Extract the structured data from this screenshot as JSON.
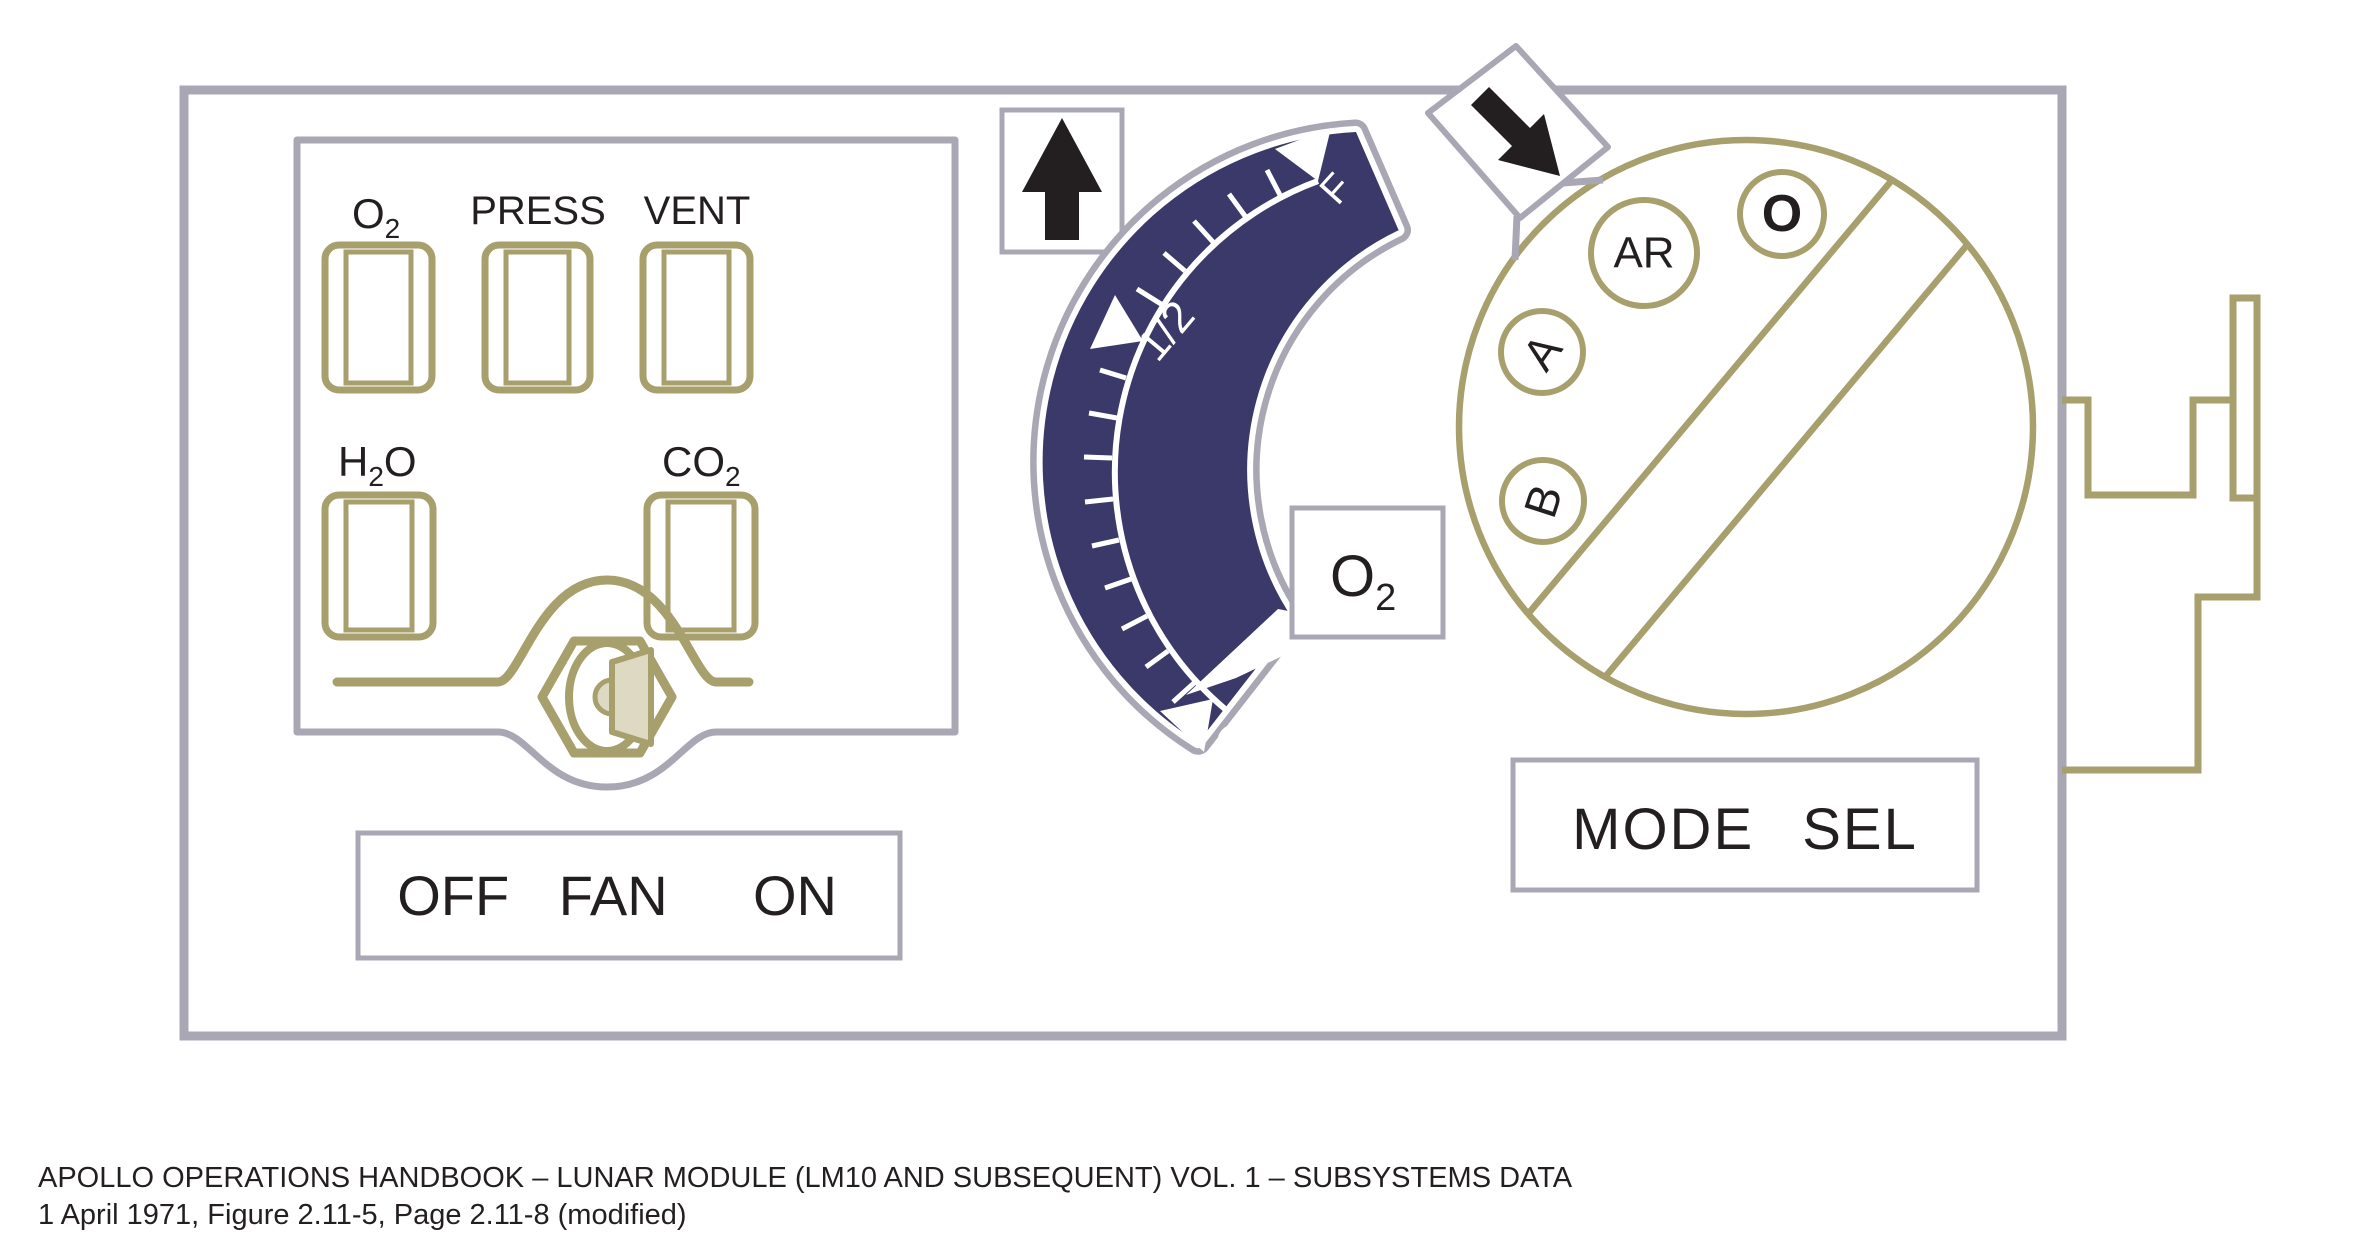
{
  "colors": {
    "panel_outline_gray": "#a8a7b3",
    "accent_olive": "#a79f6c",
    "gauge_navy": "#3b3969",
    "toggle_tan": "#ded9c3",
    "text_black": "#231f20",
    "scale_white": "#ffffff"
  },
  "left_panel": {
    "windows": [
      {
        "name": "O2",
        "pre": "O",
        "sub": "2",
        "post": ""
      },
      {
        "name": "PRESS",
        "pre": "PRESS",
        "sub": "",
        "post": ""
      },
      {
        "name": "VENT",
        "pre": "VENT",
        "sub": "",
        "post": ""
      },
      {
        "name": "H2O",
        "pre": "H",
        "sub": "2",
        "post": "O"
      },
      {
        "name": "CO2",
        "pre": "CO",
        "sub": "2",
        "post": ""
      }
    ],
    "fan_switch": {
      "labels": [
        "OFF",
        "FAN",
        "ON"
      ]
    }
  },
  "gauge": {
    "scale_labels": {
      "full": "F",
      "half": "1/2",
      "empty": "O"
    },
    "tag": {
      "pre": "O",
      "sub": "2"
    }
  },
  "mode_selector": {
    "label": "MODE SEL",
    "positions": [
      "AR",
      "O",
      "A",
      "B"
    ]
  },
  "icons": {
    "up_arrow": "up-arrow",
    "diagonal_arrow": "down-right-arrow"
  },
  "caption": {
    "line1": "APOLLO OPERATIONS HANDBOOK – LUNAR MODULE (LM10 AND SUBSEQUENT) VOL. 1 – SUBSYSTEMS DATA",
    "line2": "1 April 1971, Figure 2.11-5, Page 2.11-8 (modified)"
  }
}
